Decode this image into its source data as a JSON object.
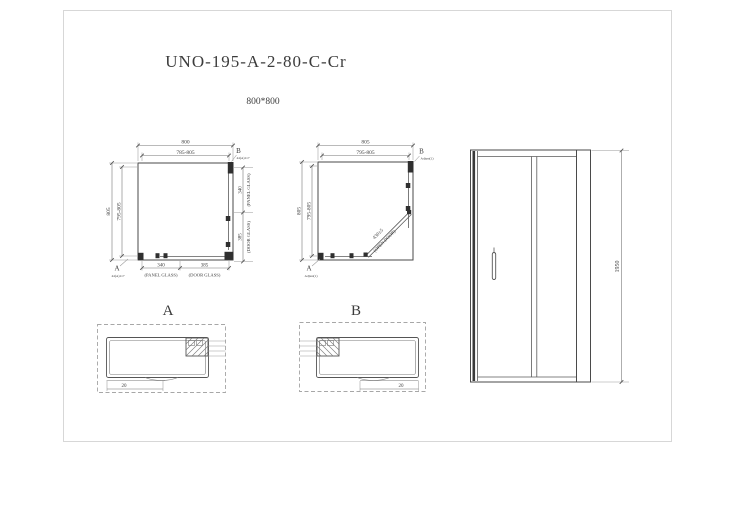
{
  "title": "UNO-195-A-2-80-C-Cr",
  "size_label": "800*800",
  "colors": {
    "line": "#4a4a4a",
    "dim_text": "#3c3c3c",
    "background": "#ffffff"
  },
  "plan_left": {
    "dim_top_outer": "800",
    "dim_top_inner": "785-805",
    "dim_left_outer": "805",
    "dim_left_inner": "795-805",
    "dim_right_panel": "340",
    "dim_right_panel_label": "(PANEL GLASS)",
    "dim_right_door": "385",
    "dim_right_door_label": "(DOOR GLASS)",
    "dim_bottom_panel": "340",
    "dim_bottom_panel_label": "(PANEL GLASS)",
    "dim_bottom_door": "385",
    "dim_bottom_door_label": "(DOOR GLASS)",
    "corner_a": "A",
    "corner_a_note": "44(A)117",
    "corner_b": "B",
    "corner_b_note": "44(A)117"
  },
  "plan_right": {
    "dim_top_outer": "805",
    "dim_top_inner": "795-805",
    "dim_left_outer": "805",
    "dim_left_inner": "795-805",
    "diag_dim": "430±5",
    "diag_label": "(OPEN DOOR)",
    "corner_a": "A",
    "corner_a_note": "Adjust(1)",
    "corner_b": "B",
    "corner_b_note": "Adjust(1)"
  },
  "elevation": {
    "dim_height": "1950"
  },
  "detail_a": {
    "label": "A",
    "dim": "20"
  },
  "detail_b": {
    "label": "B",
    "dim": "20"
  }
}
